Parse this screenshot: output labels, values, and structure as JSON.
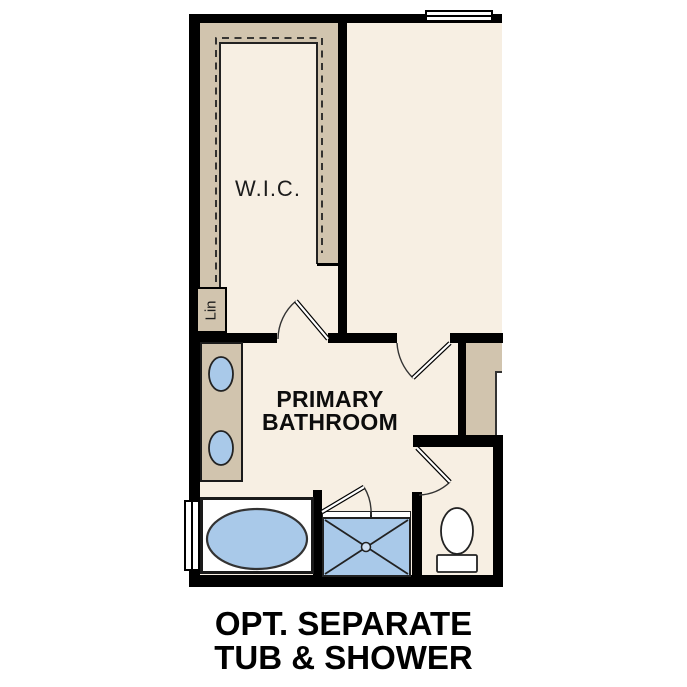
{
  "plan": {
    "rooms": {
      "wic": {
        "label": "W.I.C."
      },
      "linen_closet": {
        "label": "Lin"
      },
      "primary_bathroom": {
        "label_line1": "PRIMARY",
        "label_line2": "BATHROOM"
      }
    }
  },
  "caption": {
    "line1": "OPT. SEPARATE",
    "line2": "TUB & SHOWER"
  },
  "colors": {
    "wall": "#000000",
    "floor": "#f7efe3",
    "shelf": "#d1c4ae",
    "fixture-blue": "#a9c9e9",
    "line": "#222222",
    "text": "#111111"
  }
}
